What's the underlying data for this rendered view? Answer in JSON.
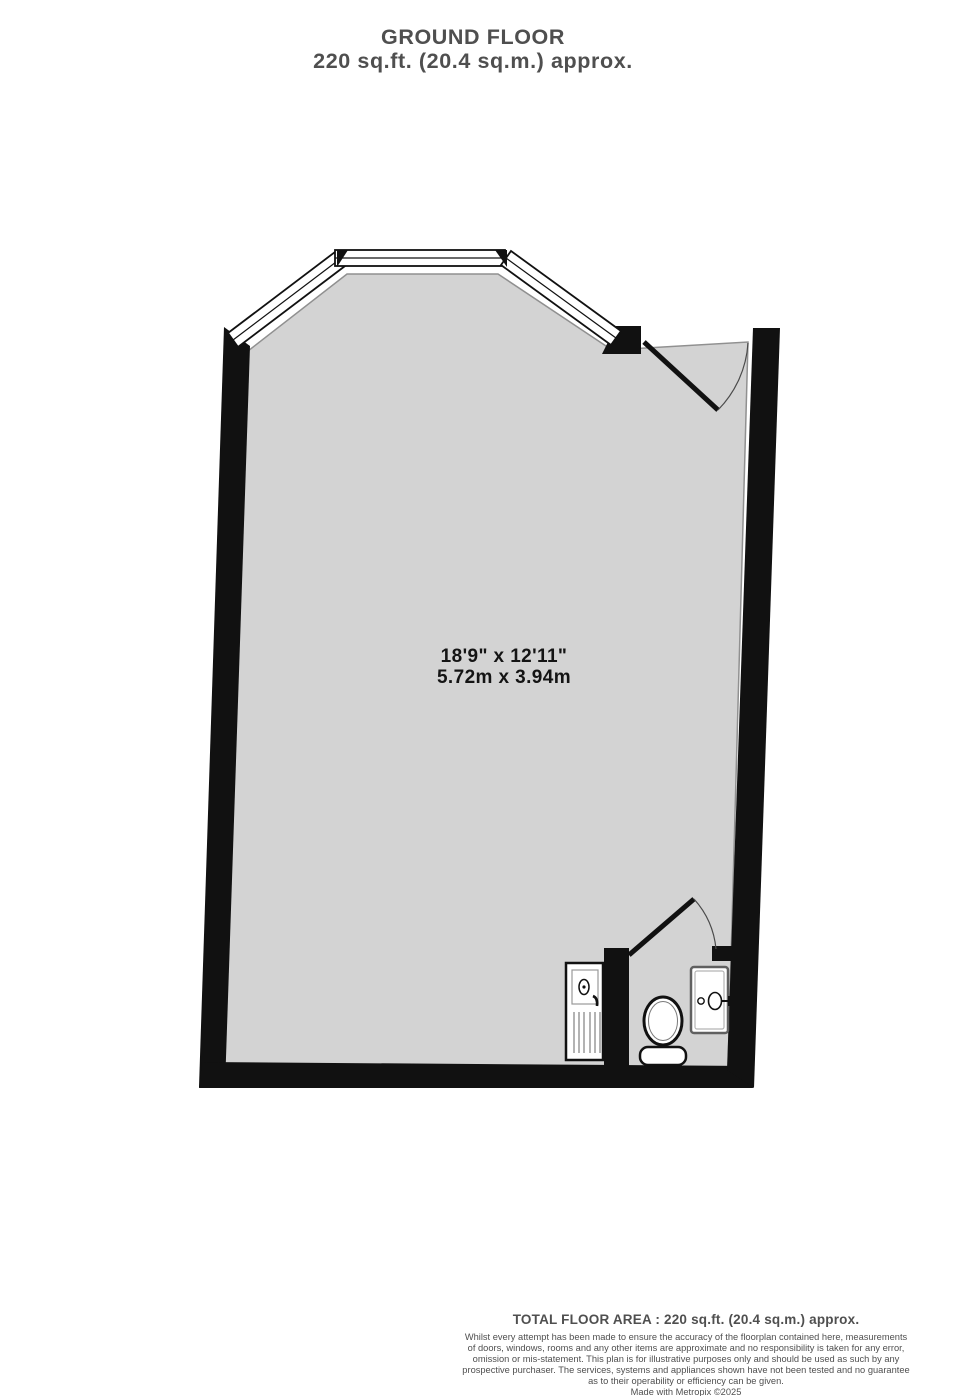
{
  "title": {
    "line1": "GROUND FLOOR",
    "line2": "220 sq.ft. (20.4 sq.m.) approx."
  },
  "room": {
    "dimensions_imperial": "18'9\"  x 12'11\"",
    "dimensions_metric": "5.72m  x 3.94m"
  },
  "fixtures": [
    {
      "icon": "bay-window-icon",
      "label": "three-pane bay window"
    },
    {
      "icon": "door-swing-icon",
      "label": "entry door top right"
    },
    {
      "icon": "door-swing-icon",
      "label": "wc door"
    },
    {
      "icon": "toilet-icon",
      "label": "toilet"
    },
    {
      "icon": "sink-drainer-icon",
      "label": "sink unit with drainer"
    },
    {
      "icon": "washbasin-icon",
      "label": "washbasin"
    }
  ],
  "footer": {
    "total_area": "TOTAL FLOOR AREA : 220 sq.ft. (20.4 sq.m.) approx.",
    "disclaimer_lines": [
      "Whilst every attempt has been made to ensure the accuracy of the floorplan contained here, measurements",
      "of doors, windows, rooms and any other items are approximate and no responsibility is taken for any error,",
      "omission or mis-statement. This plan is for illustrative purposes only and should be used as such by any",
      "prospective purchaser. The services, systems and appliances shown have not been tested and no guarantee",
      "as to their operability or efficiency can be given."
    ],
    "credit": "Made with Metropix ©2025"
  },
  "colors": {
    "room_fill": "#d3d3d3",
    "room_edge": "#909090",
    "wall": "#111111",
    "title_text": "#4f4f4f",
    "dimension_text": "#141414",
    "footer_text": "#4f4f4f"
  }
}
